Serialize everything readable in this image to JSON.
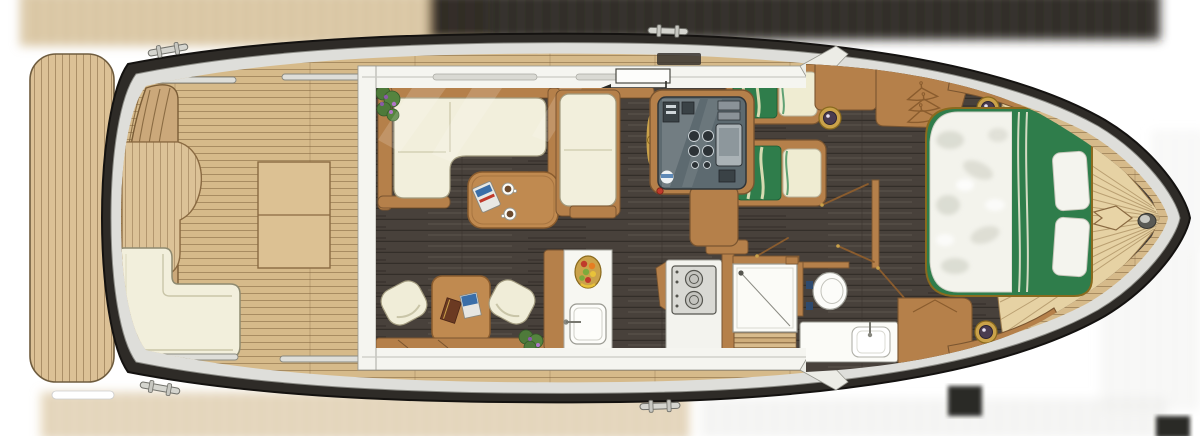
{
  "diagram_type": "yacht-deck-plan-top-view",
  "palette": {
    "background": "#ffffff",
    "hull": "#2e2b27",
    "rub_rail": "#dededa",
    "teak_deck": "#d6ba8a",
    "teak_light": "#e6d2a4",
    "swim_platform": "#dcc196",
    "interior_floor": "#48413b",
    "wood": "#b5804a",
    "wood_dark": "#7a5530",
    "upholstery": "#f2efdc",
    "upholstery_edge": "#a19a7e",
    "bedding_green": "#2f7d4b",
    "bedding_stripe": "#e9e4bc",
    "duvet_white": "#f3f3ec",
    "trim_white": "#f5f5f0",
    "gold": "#caa24a",
    "steel": "#d5d5cf",
    "console_panel": "#5d6a70",
    "streak_tan": "#c9ad7e",
    "streak_dark": "#24211d"
  },
  "vessel": {
    "areas": [
      {
        "name": "swim-platform",
        "items": [
          {
            "name": "teak-planks"
          }
        ]
      },
      {
        "name": "aft-cockpit",
        "items": [
          {
            "name": "transom-bench-slats",
            "count": 4
          },
          {
            "name": "engine-hatch",
            "panels": 2
          },
          {
            "name": "cockpit-teak-table"
          },
          {
            "name": "l-shaped-cockpit-bench"
          },
          {
            "name": "grab-rails",
            "count": 4
          },
          {
            "name": "mooring-cleats",
            "count": 4
          }
        ]
      },
      {
        "name": "salon",
        "items": [
          {
            "name": "sliding-entry-door"
          },
          {
            "name": "l-shaped-sofa"
          },
          {
            "name": "coffee-table"
          },
          {
            "name": "coffee-cups",
            "count": 2
          },
          {
            "name": "magazine"
          },
          {
            "name": "flower-pots",
            "count": 2
          },
          {
            "name": "dinette-table"
          },
          {
            "name": "dinette-chairs",
            "count": 2
          },
          {
            "name": "books",
            "count": 2
          },
          {
            "name": "window-ledge"
          }
        ]
      },
      {
        "name": "helm-station",
        "items": [
          {
            "name": "helm-bench"
          },
          {
            "name": "steering-wheel"
          },
          {
            "name": "instrument-panel"
          },
          {
            "name": "gauges",
            "count": 4
          },
          {
            "name": "chartplotter"
          },
          {
            "name": "helm-cup"
          },
          {
            "name": "chart-table"
          }
        ]
      },
      {
        "name": "galley",
        "items": [
          {
            "name": "counter"
          },
          {
            "name": "galley-sink"
          },
          {
            "name": "fruit-bowl"
          },
          {
            "name": "two-burner-cooktop",
            "burners": 2
          },
          {
            "name": "companionway-stairs",
            "steps": 4
          }
        ]
      },
      {
        "name": "twin-guest-cabin",
        "items": [
          {
            "name": "twin-berths",
            "count": 2
          },
          {
            "name": "green-striped-duvets"
          },
          {
            "name": "berth-pillows",
            "count": 2
          },
          {
            "name": "reading-light"
          },
          {
            "name": "wardrobe"
          },
          {
            "name": "clothes-hangers",
            "count": 3
          }
        ]
      },
      {
        "name": "bathroom",
        "items": [
          {
            "name": "shower-tray"
          },
          {
            "name": "toilet"
          },
          {
            "name": "vanity-washbasin"
          },
          {
            "name": "faucet"
          }
        ]
      },
      {
        "name": "master-cabin",
        "items": [
          {
            "name": "island-double-bed"
          },
          {
            "name": "white-duvet"
          },
          {
            "name": "green-foot-band"
          },
          {
            "name": "bed-pillows",
            "count": 2
          },
          {
            "name": "side-cabinets",
            "count": 2
          },
          {
            "name": "washbasin-lights",
            "count": 2
          },
          {
            "name": "door-swings",
            "count": 4
          }
        ]
      },
      {
        "name": "foredeck",
        "items": [
          {
            "name": "v-teak-planking"
          },
          {
            "name": "anchor-windlass"
          },
          {
            "name": "bow-roller"
          }
        ]
      }
    ]
  }
}
